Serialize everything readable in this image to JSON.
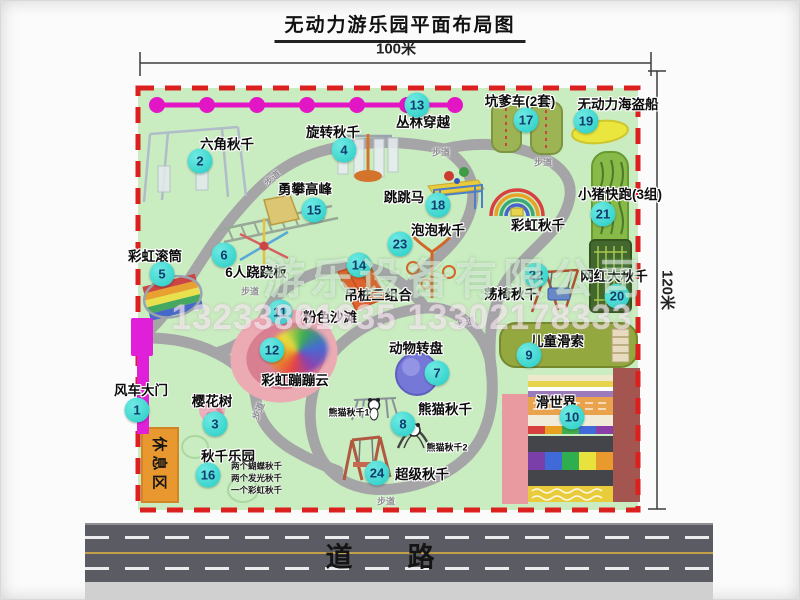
{
  "title": "无动力游乐园平面布局图",
  "dimensions": {
    "width_label": "100米",
    "height_label": "120米"
  },
  "road": {
    "label": "道　路"
  },
  "watermark": {
    "company": "游乐设备有限公司",
    "phone": "13233861635 13302178333"
  },
  "colors": {
    "border_red": "#dc1f1f",
    "map_green": "#c9ecc0",
    "path_gray": "#a5a5a8",
    "marker_teal": "#2fd3cc",
    "chain_pink": "#e316c6",
    "gate_magenta": "#e01fd9"
  },
  "map": {
    "rest_area_label": "休息区",
    "walkway_label": "步道",
    "attractions": [
      {
        "num": "1",
        "label": "风车大门",
        "cx": 137,
        "cy": 410,
        "lx": 141,
        "ly": 389
      },
      {
        "num": "2",
        "label": "六角秋千",
        "cx": 200,
        "cy": 161,
        "lx": 227,
        "ly": 143
      },
      {
        "num": "3",
        "label": "樱花树",
        "cx": 215,
        "cy": 424,
        "lx": 212,
        "ly": 400
      },
      {
        "num": "4",
        "label": "旋转秋千",
        "cx": 344,
        "cy": 150,
        "lx": 333,
        "ly": 131
      },
      {
        "num": "5",
        "label": "彩虹滚筒",
        "cx": 162,
        "cy": 274,
        "lx": 155,
        "ly": 255
      },
      {
        "num": "6",
        "label": "6人跷跷板",
        "cx": 224,
        "cy": 255,
        "lx": 256,
        "ly": 271
      },
      {
        "num": "7",
        "label": "动物转盘",
        "cx": 437,
        "cy": 373,
        "lx": 416,
        "ly": 347
      },
      {
        "num": "8",
        "label": "熊猫秋千",
        "cx": 403,
        "cy": 424,
        "lx": 445,
        "ly": 408
      },
      {
        "num": "9",
        "label": "儿童滑索",
        "cx": 529,
        "cy": 355,
        "lx": 557,
        "ly": 340
      },
      {
        "num": "10",
        "label": "滑世界",
        "cx": 572,
        "cy": 417,
        "lx": 556,
        "ly": 401
      },
      {
        "num": "11",
        "label": "粉色沙滩",
        "cx": 280,
        "cy": 312,
        "lx": 330,
        "ly": 316
      },
      {
        "num": "12",
        "label": "彩虹蹦蹦云",
        "cx": 272,
        "cy": 350,
        "lx": 295,
        "ly": 379
      },
      {
        "num": "13",
        "label": "丛林穿越",
        "cx": 417,
        "cy": 105,
        "lx": 423,
        "ly": 121
      },
      {
        "num": "14",
        "label": "吊桩三组合",
        "cx": 359,
        "cy": 265,
        "lx": 378,
        "ly": 294
      },
      {
        "num": "15",
        "label": "勇攀高峰",
        "cx": 314,
        "cy": 210,
        "lx": 305,
        "ly": 188
      },
      {
        "num": "16",
        "label": "秋千乐园",
        "cx": 208,
        "cy": 475,
        "lx": 228,
        "ly": 455
      },
      {
        "num": "17",
        "label": "坑爹车(2套)",
        "cx": 526,
        "cy": 120,
        "lx": 520,
        "ly": 100
      },
      {
        "num": "18",
        "label": "跳跳马",
        "cx": 438,
        "cy": 205,
        "lx": 404,
        "ly": 196
      },
      {
        "num": "19",
        "label": "无动力海盗船",
        "cx": 586,
        "cy": 121,
        "lx": 618,
        "ly": 103
      },
      {
        "num": "20",
        "label": "网红大秋千",
        "cx": 617,
        "cy": 296,
        "lx": 614,
        "ly": 275
      },
      {
        "num": "21",
        "label": "小猪快跑(3组)",
        "cx": 603,
        "cy": 214,
        "lx": 620,
        "ly": 193
      },
      {
        "num": "22",
        "label": "荡椅秋千",
        "cx": 536,
        "cy": 275,
        "lx": 511,
        "ly": 293
      },
      {
        "num": "23",
        "label": "泡泡秋千",
        "cx": 400,
        "cy": 244,
        "lx": 438,
        "ly": 229
      },
      {
        "num": "24",
        "label": "超级秋千",
        "cx": 377,
        "cy": 473,
        "lx": 422,
        "ly": 473
      }
    ],
    "extra_labels": [
      {
        "label": "彩虹秋千",
        "x": 538,
        "y": 224,
        "size": 13.5
      },
      {
        "label": "熊猫秋千1",
        "x": 349,
        "y": 412,
        "size": 9
      },
      {
        "label": "熊猫秋千2",
        "x": 447,
        "y": 447,
        "size": 9
      }
    ],
    "swing_details": {
      "x": 231,
      "y": 466,
      "lines": [
        "两个蝴蝶秋千",
        "两个发光秋千",
        "一个彩虹秋千"
      ]
    },
    "walkways": [
      {
        "x": 272,
        "y": 178,
        "r": -40
      },
      {
        "x": 441,
        "y": 152,
        "r": 0
      },
      {
        "x": 543,
        "y": 162,
        "r": 0
      },
      {
        "x": 250,
        "y": 291,
        "r": 0
      },
      {
        "x": 466,
        "y": 322,
        "r": -15
      },
      {
        "x": 258,
        "y": 411,
        "r": -68
      },
      {
        "x": 386,
        "y": 501,
        "r": 0
      }
    ]
  }
}
